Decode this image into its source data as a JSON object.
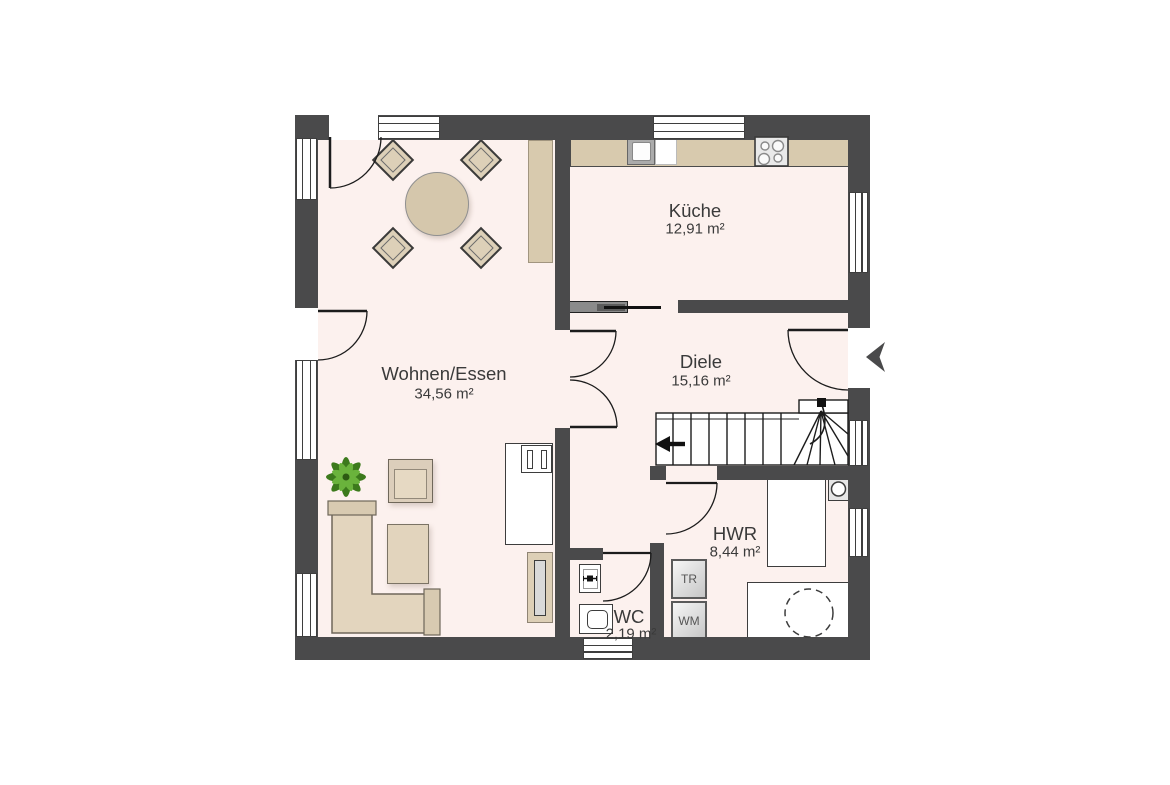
{
  "plan": {
    "rooms": {
      "kueche": {
        "name": "Küche",
        "area": "12,91 m²"
      },
      "wohnen_essen": {
        "name": "Wohnen/Essen",
        "area": "34,56 m²"
      },
      "diele": {
        "name": "Diele",
        "area": "15,16 m²"
      },
      "hwr": {
        "name": "HWR",
        "area": "8,44 m²"
      },
      "wc": {
        "name": "WC",
        "area": "2,19 m²"
      }
    },
    "appliances": {
      "dryer_label": "TR",
      "washer_label": "WM"
    },
    "colors": {
      "wall": "#4a4a4b",
      "floor": "#fcf1ee",
      "counter": "#d8caae",
      "furniture": "#e2d4bd",
      "furniture_dark": "#d8cab1",
      "outline": "#2e2e2e",
      "plant_green": "#6ab33c",
      "plant_dark": "#3c7a1c"
    }
  }
}
